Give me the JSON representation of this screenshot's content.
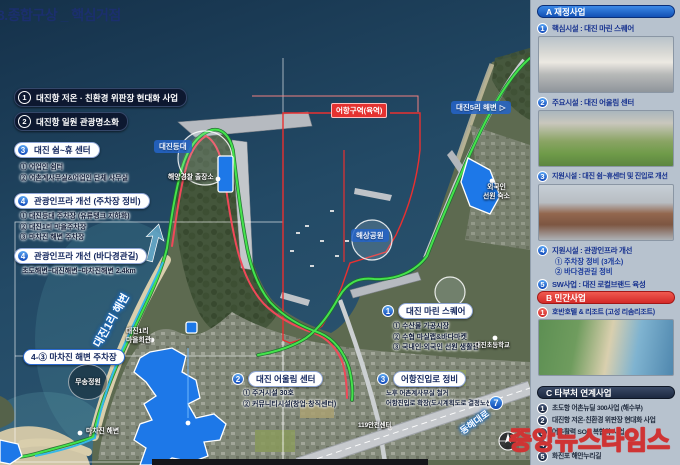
{
  "title": "3.종합구상 _ 핵심거점",
  "map": {
    "legend": [
      {
        "num": "1",
        "label": "대진항 저온 · 친환경 위판장 현대화 사업"
      },
      {
        "num": "2",
        "label": "대진항 일원 관광명소화"
      },
      {
        "num": "3",
        "label": "대진 쉼~휴 센터",
        "sub1": "① 어업인 쉼터",
        "sub2": "② 어촌계사무실&어업인 단체 사무실"
      },
      {
        "num": "4",
        "label": "관광인프라 개선 (주차장 정비)",
        "sub1": "① 대진등대 주차장 (유류탱크 지하화)",
        "sub2": "② 대진1리 마을주차장",
        "sub3": "③ 마차진 해변 주차장"
      },
      {
        "num": "4",
        "label": "관광인프라 개선 (바다경관길)",
        "sub1": "초도해변~대진해변~마차진해변 2.4km"
      }
    ],
    "sites": [
      {
        "num": "1",
        "label": "대진 마린 스퀘어",
        "sub1": "① 수산물 가공시장",
        "sub2": "② 수협 마실랩&바다마켓",
        "sub3": "③ 국내인·외국인 선원 생활관"
      },
      {
        "num": "2",
        "label": "대진 어울림 센터",
        "sub1": "① 주거시설 30호",
        "sub2": "② 커뮤니티시설(창업·창직센터)"
      },
      {
        "num": "3",
        "label": "어항진입로 정비",
        "sub1": "노후 어촌계사무실 철거",
        "sub2": "어항진입로 확장(도시계획도로 결정노선)"
      }
    ],
    "labels": {
      "port_zone": "어항구역(육역)",
      "beach5": "대진5리 해변",
      "beach5_arrow": "▷",
      "lighthouse": "대진등대",
      "marine_park": "해상공원",
      "coast_guard": "해양경찰 출장소",
      "foreign_quarters": "외국인\n선원 숙소",
      "village_hall": "대진1리\n마을회관",
      "beach1": "대진1리 해변",
      "machajin_beach": "마차진 해변",
      "parking_callout": "4-③ 마차진 해변 주차장",
      "musong_park": "무송정원",
      "school": "대진초등학교",
      "fire_station": "119안전센터",
      "road_no": "7",
      "road_name": "동해대로"
    }
  },
  "sidebar": {
    "section_a": {
      "header": "A 재정사업",
      "i1": {
        "num": "1",
        "text": "핵심시설 : 대진 마린 스퀘어"
      },
      "i2": {
        "num": "2",
        "text": "주요시설 : 대진 어울림 센터"
      },
      "i3": {
        "num": "3",
        "text": "지원시설 : 대진 쉼~휴센터 및 진입로 개선"
      },
      "i4": {
        "num": "4",
        "text": "지원시설 : 관광인프라 개선",
        "sub1": "① 주차장 정비 (3개소)",
        "sub2": "② 바다경관길 정비"
      },
      "i5": {
        "num": "5",
        "text": "SW사업 : 대진 로컬브랜드 육성"
      }
    },
    "section_b": {
      "header": "B 민간사업",
      "i1": {
        "num": "1",
        "text": "호반호텔 & 리조트 (고성 리솜리조트)"
      }
    },
    "section_c": {
      "header": "C 타부처 연계사업",
      "i1": {
        "num": "1",
        "text": "초도항 어촌뉴딜 300사업 (해수부)"
      },
      "i2": {
        "num": "2",
        "text": "대진항 저온·친환경 위판장 현대화 사업"
      },
      "i3": {
        "num": "3",
        "text": "어촌활력 SOC 복합화 사업"
      },
      "i4": {
        "num": "4",
        "text": ""
      },
      "i5": {
        "num": "5",
        "text": "화진포 해안누리길"
      }
    }
  },
  "watermark": "중앙뉴스타임스",
  "colors": {
    "accent_blue": "#1d6fe0",
    "accent_red": "#e8403a",
    "navy": "#14264f",
    "path_green": "#3fe043",
    "zone_red": "#ee3030",
    "poly_blue": "#1d78e8"
  }
}
